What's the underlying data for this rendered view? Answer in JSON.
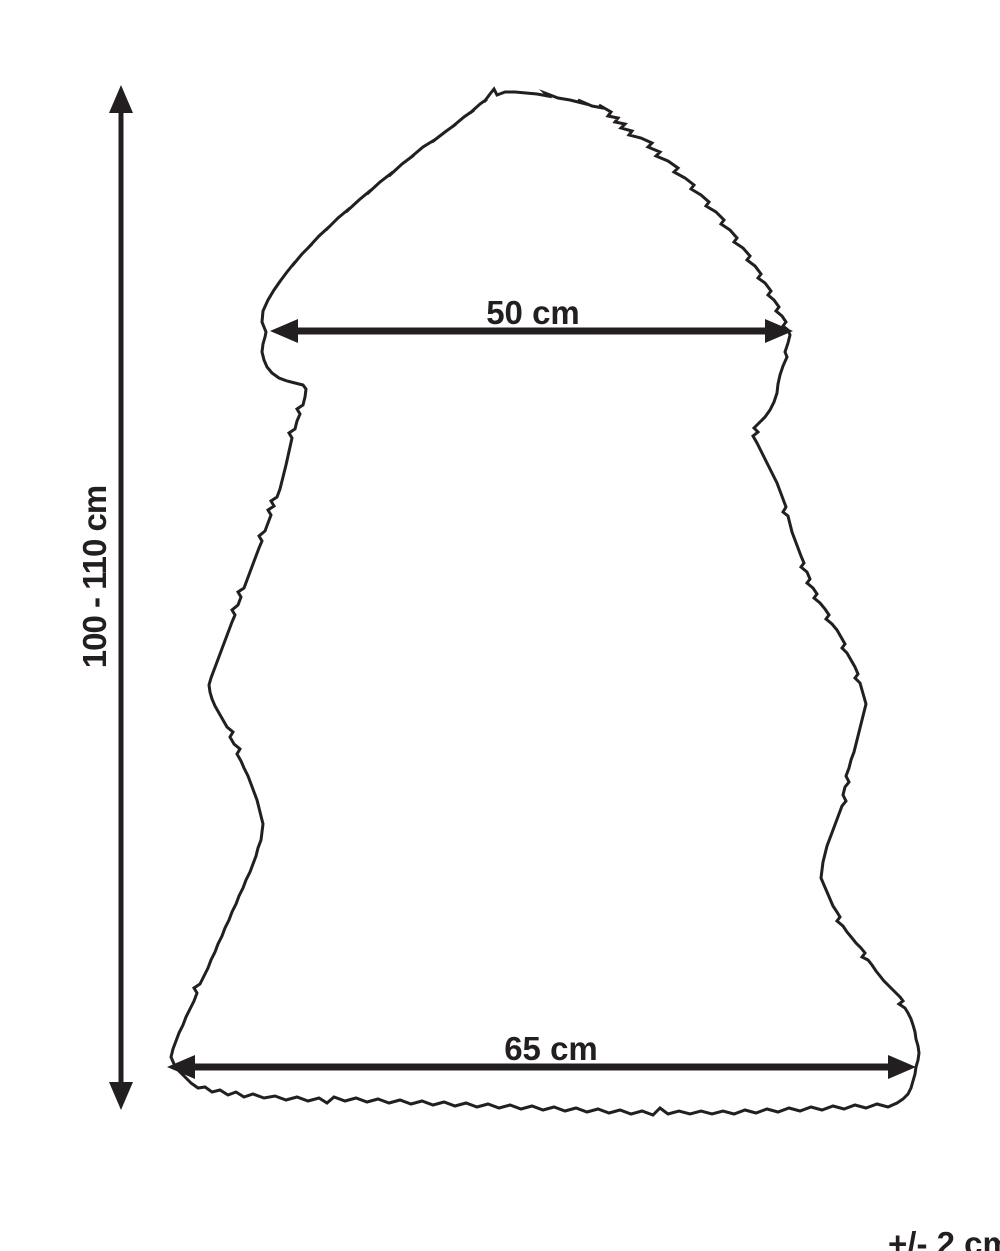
{
  "colors": {
    "line": "#231f20",
    "background": "#ffffff"
  },
  "diagram": {
    "measurements": {
      "height": {
        "label": "100 - 110 cm"
      },
      "top_width": {
        "label": "50 cm"
      },
      "bottom_width": {
        "label": "65 cm"
      },
      "tolerance": {
        "label": "+/- 2 cm"
      }
    }
  }
}
